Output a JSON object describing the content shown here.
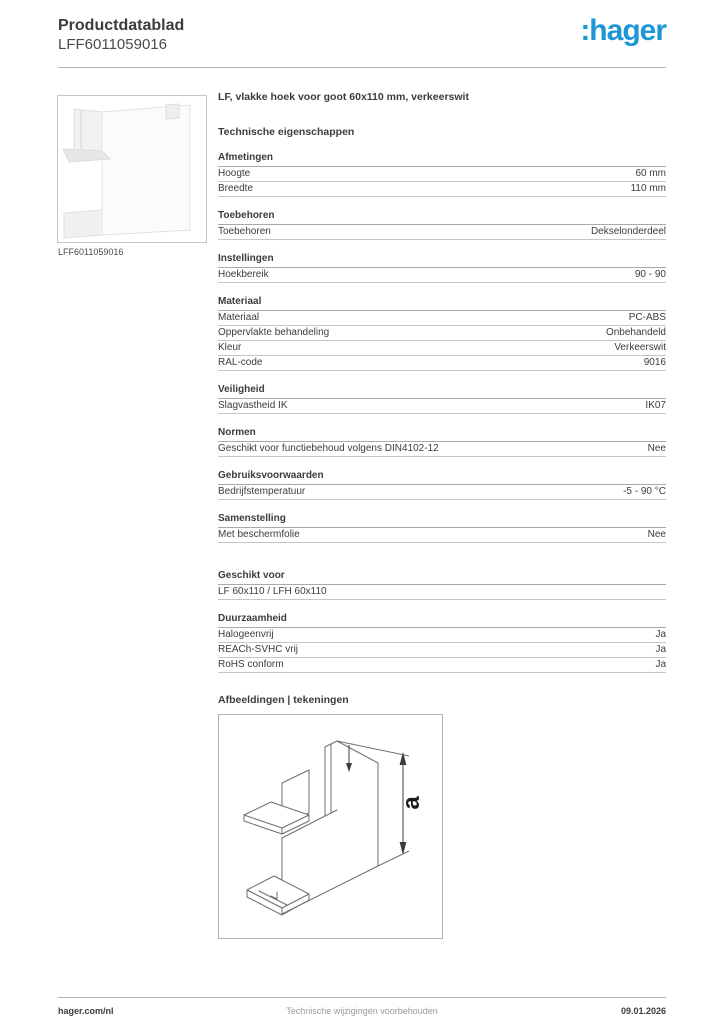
{
  "header": {
    "doc_type": "Productdatablad",
    "product_code": "LFF6011059016",
    "logo_text": ":hager",
    "brand_color": "#1e96d4"
  },
  "product": {
    "image_caption": "LFF6011059016",
    "title": "LF, vlakke hoek voor goot 60x110 mm, verkeerswit"
  },
  "tech_title": "Technische eigenschappen",
  "sections": [
    {
      "title": "Afmetingen",
      "rows": [
        {
          "label": "Hoogte",
          "value": "60 mm"
        },
        {
          "label": "Breedte",
          "value": "110 mm"
        }
      ]
    },
    {
      "title": "Toebehoren",
      "rows": [
        {
          "label": "Toebehoren",
          "value": "Dekselonderdeel"
        }
      ]
    },
    {
      "title": "Instellingen",
      "rows": [
        {
          "label": "Hoekbereik",
          "value": "90 - 90"
        }
      ]
    },
    {
      "title": "Materiaal",
      "rows": [
        {
          "label": "Materiaal",
          "value": "PC-ABS"
        },
        {
          "label": "Oppervlakte behandeling",
          "value": "Onbehandeld"
        },
        {
          "label": "Kleur",
          "value": "Verkeerswit"
        },
        {
          "label": "RAL-code",
          "value": "9016"
        }
      ]
    },
    {
      "title": "Veiligheid",
      "rows": [
        {
          "label": "Slagvastheid IK",
          "value": "IK07"
        }
      ]
    },
    {
      "title": "Normen",
      "rows": [
        {
          "label": "Geschikt voor functiebehoud volgens DIN4102-12",
          "value": "Nee"
        }
      ]
    },
    {
      "title": "Gebruiksvoorwaarden",
      "rows": [
        {
          "label": "Bedrijfstemperatuur",
          "value": "-5 - 90 °C"
        }
      ]
    },
    {
      "title": "Samenstelling",
      "rows": [
        {
          "label": "Met beschermfolie",
          "value": "Nee"
        }
      ]
    },
    {
      "title": "Geschikt voor",
      "gap_before": true,
      "rows": [
        {
          "label": "LF 60x110 / LFH 60x110",
          "value": ""
        }
      ]
    },
    {
      "title": "Duurzaamheid",
      "rows": [
        {
          "label": "Halogeenvrij",
          "value": "Ja"
        },
        {
          "label": "REACh-SVHC vrij",
          "value": "Ja"
        },
        {
          "label": "RoHS conform",
          "value": "Ja"
        }
      ]
    }
  ],
  "drawings_title": "Afbeeldingen | tekeningen",
  "drawing": {
    "dimension_label": "a"
  },
  "footer": {
    "left": "hager.com/nl",
    "center": "Technische wijzigingen voorbehouden",
    "right": "09.01.2026"
  }
}
